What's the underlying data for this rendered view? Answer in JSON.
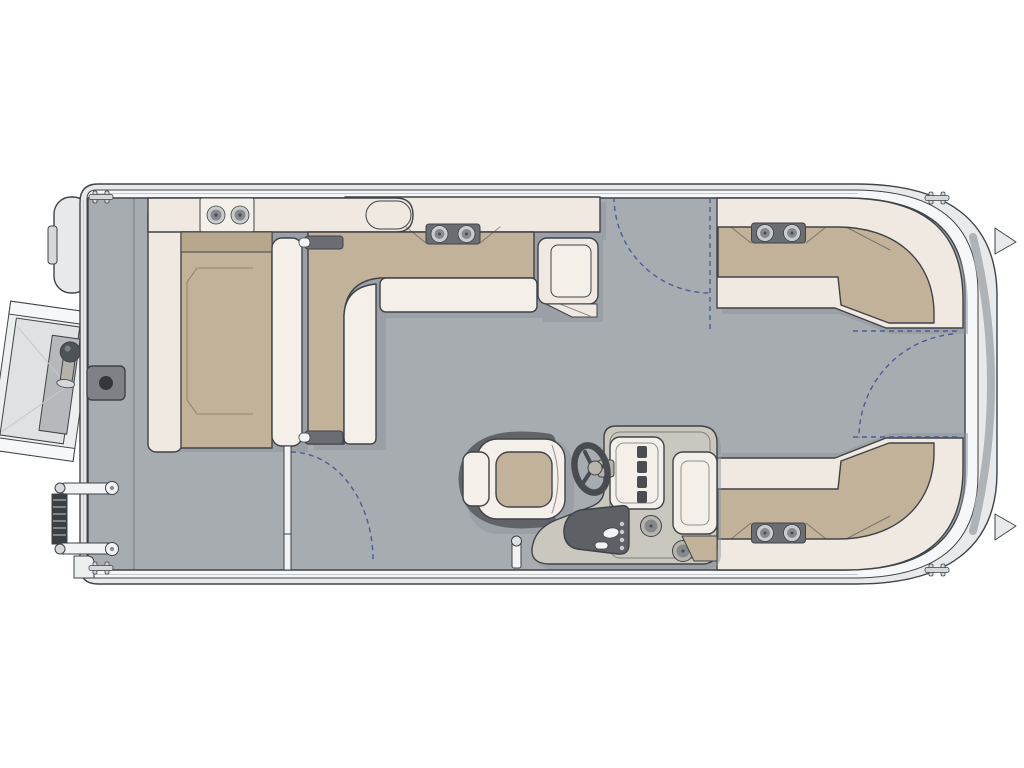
{
  "meta": {
    "title": "Pontoon boat deck floor plan",
    "view": "top-down overhead layout",
    "bow_direction": "right",
    "stern_direction": "left"
  },
  "colors": {
    "background": "#ffffff",
    "outline": "#3f4347",
    "hull": "#e7e9ea",
    "rail": "#f6f7f8",
    "deck": "#a7acb1",
    "bow_band": "#aeb3b8",
    "shadow": "#8e9399",
    "cream": "#efe9e1",
    "cream_bright": "#f4efe8",
    "tan": "#c2b29a",
    "tan_dark": "#b7a88d",
    "accent_dark": "#6a6e72",
    "cup_ring": "#c9ccce",
    "cup_inner": "#85898d",
    "dot_dark": "#4a4e52",
    "console": "#cac7bf",
    "console_panel": "#5d6165",
    "console_ring": "#b7b4ac",
    "wheel": "#484c50",
    "chair_frame": "#606468",
    "gate_dash": "#4c5c96",
    "pedestal": "#7e8286",
    "pedestal_dot": "#34383c",
    "ladder_dark": "#3b3f43",
    "metal_light": "#d5d7d9",
    "white_detail": "#f2f3f4",
    "platform_light": "#edefef",
    "platform_mid": "#dfe1e2",
    "platform_dark": "#b6b9bc",
    "stitch": "#94866f",
    "knob": "#4e5357",
    "stem": "#b5b2aa",
    "seam_gray": "#c6c9cb"
  },
  "legend": {
    "features": [
      {
        "id": "stern-lounge",
        "label": "Aft L-shaped lounge with cup holders"
      },
      {
        "id": "port-bench",
        "label": "Port midship L-bench with armrest"
      },
      {
        "id": "bow-port-couch",
        "label": "Bow port wraparound couch"
      },
      {
        "id": "bow-starboard-couch",
        "label": "Bow starboard wraparound couch"
      },
      {
        "id": "helm-console",
        "label": "Helm console with steering wheel and switch panel"
      },
      {
        "id": "captains-chair",
        "label": "Captain's chair"
      },
      {
        "id": "jump-seat",
        "label": "Co-captain seat backrest"
      },
      {
        "id": "side-gate",
        "label": "Port side boarding gate swing"
      },
      {
        "id": "bow-gates",
        "label": "Bow gate swings"
      },
      {
        "id": "swim-platform",
        "label": "Stern swim platform with ski pylon"
      },
      {
        "id": "boarding-ladder",
        "label": "Folded stern boarding ladder"
      },
      {
        "id": "outboard-motor",
        "label": "Outboard motor"
      },
      {
        "id": "pedestal-base",
        "label": "Table pedestal base"
      },
      {
        "id": "deck-post",
        "label": "Deck post behind helm"
      },
      {
        "id": "cleats",
        "label": "Mooring cleats"
      }
    ]
  },
  "counts": {
    "gate_swing_arcs": 3,
    "mooring_cleats": 4,
    "cup_holder_pairs": 4,
    "console_cup_holders": 2
  }
}
